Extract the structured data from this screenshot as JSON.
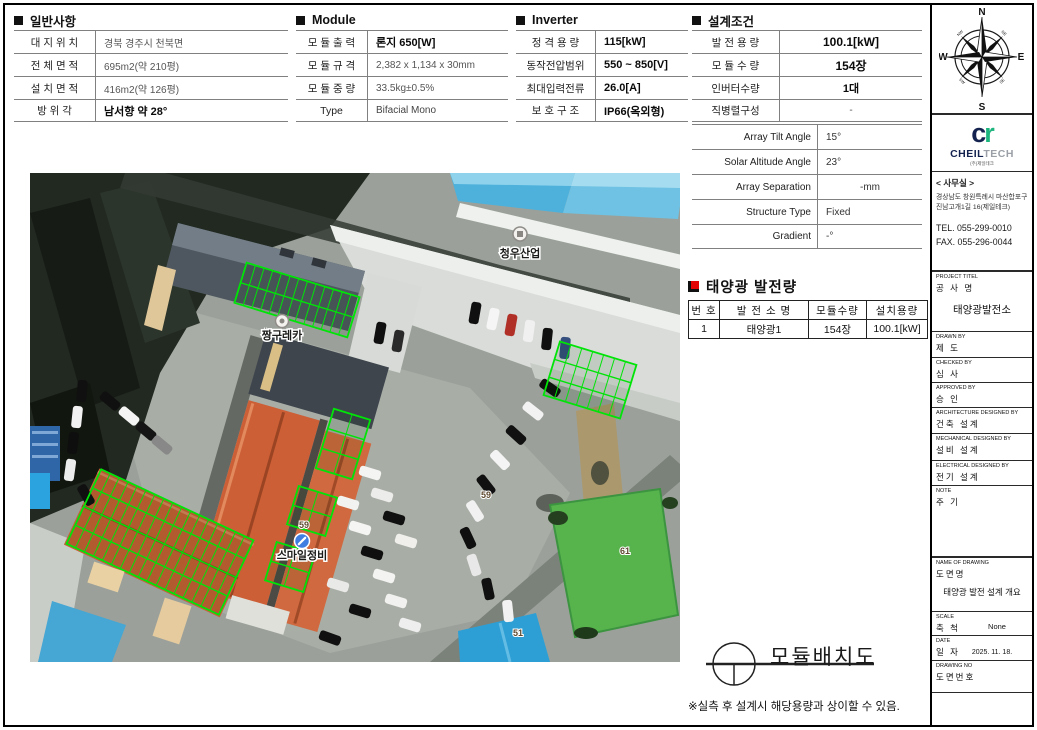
{
  "sections": {
    "general": {
      "title": "일반사항",
      "rows": [
        {
          "label": "대 지 위 치",
          "value": "경북 경주시 천북면"
        },
        {
          "label": "전 체 면 적",
          "value": "695m2(약 210평)"
        },
        {
          "label": "설 치 면 적",
          "value": "416m2(약 126평)"
        },
        {
          "label": "방  위  각",
          "value": "남서향 약 28°"
        }
      ]
    },
    "module": {
      "title": "Module",
      "rows": [
        {
          "label": "모 듈 출 력",
          "value": "론지 650[W]"
        },
        {
          "label": "모 듈 규 격",
          "value": "2,382 x 1,134 x 30mm"
        },
        {
          "label": "모 듈 중 량",
          "value": "33.5kg±0.5%"
        },
        {
          "label": "Type",
          "value": "Bifacial Mono"
        }
      ]
    },
    "inverter": {
      "title": "Inverter",
      "rows": [
        {
          "label": "정 격 용 량",
          "value": "115[kW]"
        },
        {
          "label": "동작전압범위",
          "value": "550 ~ 850[V]"
        },
        {
          "label": "최대입력전류",
          "value": "26.0[A]"
        },
        {
          "label": "보 호 구 조",
          "value": "IP66(옥외형)"
        }
      ]
    },
    "design": {
      "title": "설계조건",
      "rows": [
        {
          "label": "발 전 용 량",
          "value": "100.1[kW]"
        },
        {
          "label": "모 듈 수 량",
          "value": "154장"
        },
        {
          "label": "인버터수량",
          "value": "1대"
        },
        {
          "label": "직병렬구성",
          "value": "-"
        }
      ],
      "rows_en": [
        {
          "label": "Array Tilt Angle",
          "value": "15°"
        },
        {
          "label": "Solar Altitude Angle",
          "value": "23°"
        },
        {
          "label": "Array Separation",
          "value": "-mm"
        },
        {
          "label": "Structure Type",
          "value": "Fixed"
        },
        {
          "label": "Gradient",
          "value": "-°"
        }
      ]
    },
    "generation": {
      "title": "태양광 발전량",
      "headers": [
        "번 호",
        "발 전 소 명",
        "모듈수량",
        "설치용량"
      ],
      "row": [
        "1",
        "태양광1",
        "154장",
        "100.1[kW]"
      ]
    }
  },
  "bottom": {
    "drawing_title": "모듈배치도",
    "note": "※실측 후 설계시 해당용량과 상이할 수 있음."
  },
  "titleblock": {
    "compass": {
      "n": "N",
      "e": "E",
      "s": "S",
      "w": "W",
      "ne": "NE",
      "nw": "NW",
      "se": "SE",
      "sw": "SW"
    },
    "logo": {
      "mono_c": "c",
      "mono_r": "r",
      "name_bold": "CHEIL",
      "name_light": "TECH",
      "subtitle": "(주)제일테크"
    },
    "office": {
      "heading": "< 사무실 >",
      "address1": "경상남도 창원특례시 마산합포구",
      "address2": "진남고개1길 16(제일테크)",
      "tel": "TEL. 055-299-0010",
      "fax": "FAX. 055-296-0044"
    },
    "cells": [
      {
        "en": "PROJECT TITEL",
        "ko": "공 사 명",
        "value": "태양광발전소"
      },
      {
        "en": "DRAWN BY",
        "ko": "제 도",
        "value": ""
      },
      {
        "en": "CHECKED BY",
        "ko": "심 사",
        "value": ""
      },
      {
        "en": "APPROVED BY",
        "ko": "승 인",
        "value": ""
      },
      {
        "en": "ARCHITECTURE DESIGNED BY",
        "ko": "건축 설계",
        "value": ""
      },
      {
        "en": "MECHANICAL DESIGNED BY",
        "ko": "설비 설계",
        "value": ""
      },
      {
        "en": "ELECTRICAL DESIGNED BY",
        "ko": "전기 설계",
        "value": ""
      },
      {
        "en": "NOTE",
        "ko": "주 기",
        "value": ""
      },
      {
        "en": "NAME OF DRAWING",
        "ko": "도면명",
        "value": "태양광 발전 설계 개요"
      },
      {
        "en": "SCALE",
        "ko": "축 척",
        "value": "None"
      },
      {
        "en": "DATE",
        "ko": "일 자",
        "value": "2025. 11. 18."
      },
      {
        "en": "DRAWING NO",
        "ko": "도면번호",
        "value": ""
      }
    ]
  },
  "map": {
    "panel_color": "#00e408",
    "labels": {
      "cheongwoo": "청우산업",
      "jjanggu": "짱구레카",
      "smile": "스마일정비"
    },
    "parcels": [
      "59",
      "59",
      "61",
      "51"
    ],
    "arrays": [
      {
        "cx": 267,
        "cy": 127,
        "w": 118,
        "h": 42,
        "rows": 2,
        "cols": 13,
        "angle": 17
      },
      {
        "cx": 560,
        "cy": 207,
        "w": 80,
        "h": 56,
        "rows": 3,
        "cols": 7,
        "angle": 17
      },
      {
        "cx": 313,
        "cy": 271,
        "w": 38,
        "h": 62,
        "rows": 3,
        "cols": 2,
        "angle": 17
      },
      {
        "cx": 282,
        "cy": 338,
        "w": 40,
        "h": 40,
        "rows": 2,
        "cols": 2,
        "angle": 17
      },
      {
        "cx": 260,
        "cy": 394,
        "w": 40,
        "h": 40,
        "rows": 2,
        "cols": 2,
        "angle": 17
      },
      {
        "cx": 130,
        "cy": 369,
        "w": 168,
        "h": 82,
        "rows": 4,
        "cols": 17,
        "angle": 25
      }
    ]
  }
}
